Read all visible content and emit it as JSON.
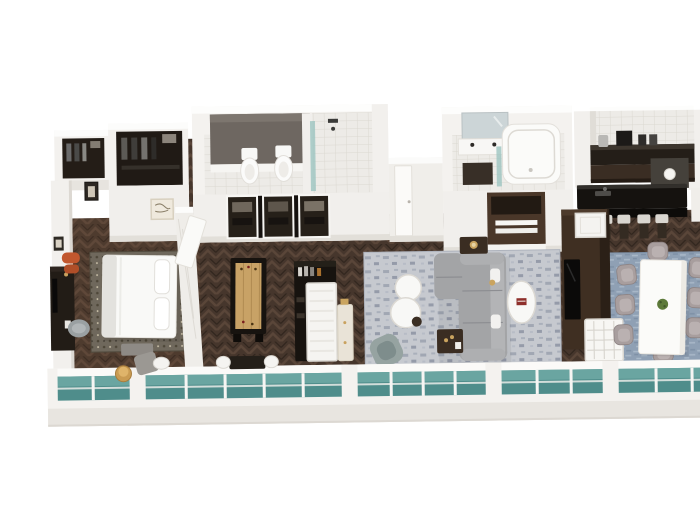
{
  "meta": {
    "title": "3D hotel suite floor plan",
    "description": "Isometric 3D rendered floor plan of a long luxury suite: entry closets, master bathroom with twin toilets and walk-in shower, master bedroom with king bed, games and bar area with shuffleboard table, guest bathroom with bathtub and double vanity, living room with sectional sofa, kitchen with black island bar and four stools, and dining room with eight chairs, fronted by a full-width teal glass window wall."
  },
  "palette": {
    "background": "#ffffff",
    "floor_wood": "#46362c",
    "wall_white": "#f3f1ee",
    "wall_top": "#fcfcfb",
    "wall_shadow": "#d9d6d1",
    "glass_teal": "#4f8d8b",
    "glass_teal_light": "#6ea9a4",
    "rug_bedroom": "#6f685c",
    "rug_living": "#c6c9cf",
    "rug_dining": "#8fa0b4",
    "sofa_gray": "#a3a4a6",
    "bed_white": "#f9f9f7",
    "counter_black": "#15120f",
    "cabinet_brown": "#4a3729",
    "media_brown": "#3f2f22",
    "wood_shuffleboard": "#c8a266",
    "accent_orange": "#c2572e",
    "accent_gold": "#c9a25f",
    "dark_furniture": "#221c16",
    "dining_chair": "#a89e9e",
    "stool_seat": "#d9d6d0",
    "tile": "#edebe7",
    "accent_wall_gray": "#6e6761"
  },
  "rooms": [
    {
      "id": "entry-closet",
      "name": "Entry and wardrobe closets",
      "furniture": [
        "dark wardrobe with clothes",
        "walk-in closet",
        "framed art"
      ]
    },
    {
      "id": "master-bathroom",
      "name": "Master bathroom",
      "furniture": [
        "toilet",
        "bidet",
        "walk-in shower with glass panel",
        "gray accent wall",
        "framed wardrobe units"
      ]
    },
    {
      "id": "master-bedroom",
      "name": "Master bedroom",
      "furniture": [
        "king bed with white duvet",
        "patterned area rug",
        "media console with TV",
        "desk chair",
        "orange ottoman",
        "foot bench",
        "window-side table and chairs"
      ]
    },
    {
      "id": "games-bar-area",
      "name": "Games and bar area",
      "furniture": [
        "shuffleboard table",
        "black bar cabinet with bottles",
        "white display panel",
        "cream drinks cabinet"
      ]
    },
    {
      "id": "guest-bathroom",
      "name": "Guest bathroom",
      "furniture": [
        "double vanity with mirror",
        "bathtub",
        "glass shower panel",
        "linen cabinet with towels"
      ]
    },
    {
      "id": "living-room",
      "name": "Living room",
      "furniture": [
        "gray sectional sofa",
        "nesting round coffee tables",
        "oval coffee table with red book",
        "side tables with gold lamps",
        "blue-gray accent chair"
      ]
    },
    {
      "id": "media-wall",
      "name": "Double-sided media wall",
      "furniture": [
        "TV",
        "white lattice end panel",
        "white threshold mat"
      ]
    },
    {
      "id": "kitchen",
      "name": "Kitchen and bar",
      "furniture": [
        "tiled backsplash",
        "back counter with coffee station",
        "black island counter",
        "four bar stools",
        "round bar sink"
      ]
    },
    {
      "id": "dining-room",
      "name": "Dining room",
      "furniture": [
        "white rectangular dining table",
        "eight tub chairs",
        "green plant centerpiece",
        "gallery wall with three frames"
      ]
    }
  ],
  "windows": {
    "description": "Full-width low window wall along the front facade",
    "glass": "teal glass panes with white mullions and pillars"
  }
}
